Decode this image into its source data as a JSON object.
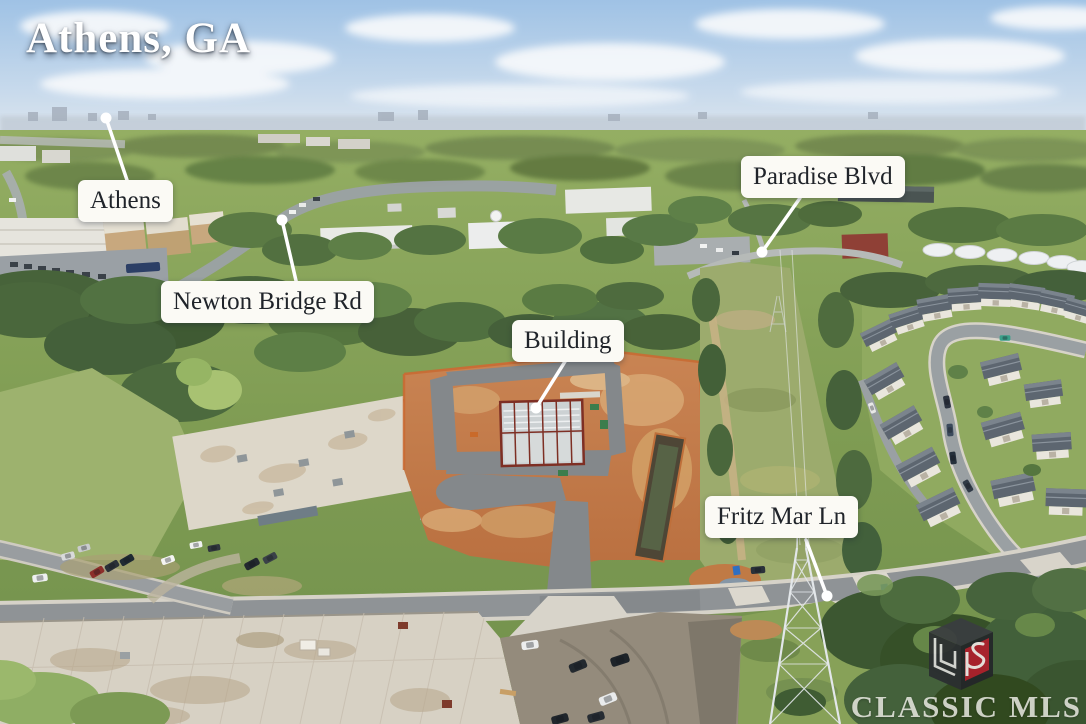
{
  "title": "Athens, GA",
  "labels": {
    "athens": "Athens",
    "newton_bridge_rd": "Newton Bridge Rd",
    "paradise_blvd": "Paradise Blvd",
    "building": "Building",
    "fritz_mar_ln": "Fritz Mar Ln"
  },
  "watermark": {
    "text": "CLASSIC MLS",
    "logo_icon": "classic-mls-ls-cube-logo"
  },
  "colors": {
    "label_background": "#fbfaf5",
    "label_text": "#20242a",
    "title_text": "#ffffff",
    "leader_line": "#ffffff",
    "watermark_text": "rgba(242,241,234,0.82)",
    "logo_red": "#b01f2c",
    "logo_dark": "#2b2e31",
    "sky": "#a3c4e6",
    "vegetation": "#5f8248",
    "construction_dirt": "#c57f4e",
    "asphalt": "#8f9396"
  }
}
